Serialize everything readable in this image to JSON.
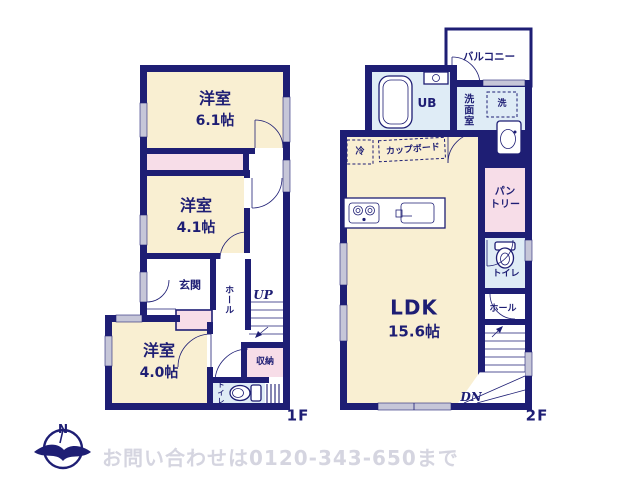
{
  "colors": {
    "wall_navy": "#1e1e74",
    "room_cream": "#f9efd2",
    "closet_pink": "#f7dde8",
    "wet_blue": "#dfecf6",
    "window_gray": "#c6c6d8",
    "footer_gray": "#d5d5e0"
  },
  "floor1": {
    "floor_label": "1F",
    "bedroom1_name": "洋室",
    "bedroom1_size": "6.1帖",
    "bedroom2_name": "洋室",
    "bedroom2_size": "4.1帖",
    "bedroom3_name": "洋室",
    "bedroom3_size": "4.0帖",
    "entrance": "玄関",
    "hall": "ホール",
    "stairs_up": "UP",
    "storage": "収納",
    "toilet": "トイレ"
  },
  "floor2": {
    "floor_label": "2F",
    "ldk_name": "LDK",
    "ldk_size": "15.6帖",
    "balcony": "バルコニー",
    "unit_bath": "UB",
    "washroom": "洗面室",
    "washer": "洗",
    "fridge": "冷",
    "cupboard": "カップボード",
    "pantry_line1": "パン",
    "pantry_line2": "トリー",
    "toilet": "トイレ",
    "hall": "ホール",
    "stairs_down": "DN"
  },
  "footer": {
    "compass_north": "N",
    "contact": "お問い合わせは0120-343-650まで"
  }
}
